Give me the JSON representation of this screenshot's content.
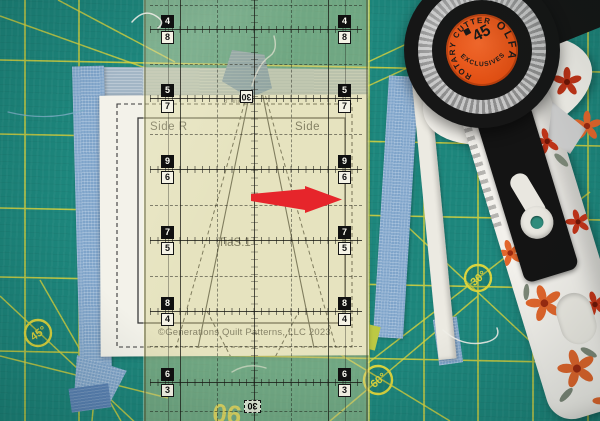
{
  "mat": {
    "surface_color": "#1d867c",
    "grid_color": "#d9d33c",
    "angle_labels": [
      {
        "text": "45°"
      },
      {
        "text": "60°"
      },
      {
        "text": "30°"
      },
      {
        "text": "60°"
      }
    ],
    "baseline_label": "90"
  },
  "template_sheet": {
    "label_left": "Side R",
    "label_right": "Side",
    "label_center": "TiaS.1",
    "size_note": "3\" finished",
    "copyright": "©Generations Quilt Patterns, LLC 2023"
  },
  "ruler": {
    "tint_color": "#d6d08c",
    "rows": [
      {
        "top": "4",
        "bottom": "8"
      },
      {
        "top": "5",
        "bottom": "7"
      },
      {
        "top": "9",
        "bottom": "6"
      },
      {
        "top": "7",
        "bottom": "5"
      },
      {
        "top": "8",
        "bottom": "4"
      },
      {
        "top": "6",
        "bottom": "3"
      }
    ],
    "center_label": "30",
    "edge_label": "30"
  },
  "rotary_cutter": {
    "brand": "OLFA",
    "ring_text_top": "ROTARY CUTTER",
    "ring_text_bottom": "EXCLUSIVES",
    "blade_size": "45",
    "label_color": "#e85a1f"
  },
  "fabric": {
    "strip_color": "#7fa4ca",
    "scrap_color": "#5a82b4"
  },
  "annotation": {
    "arrow_direction": "right",
    "arrow_color": "#e6252b"
  }
}
